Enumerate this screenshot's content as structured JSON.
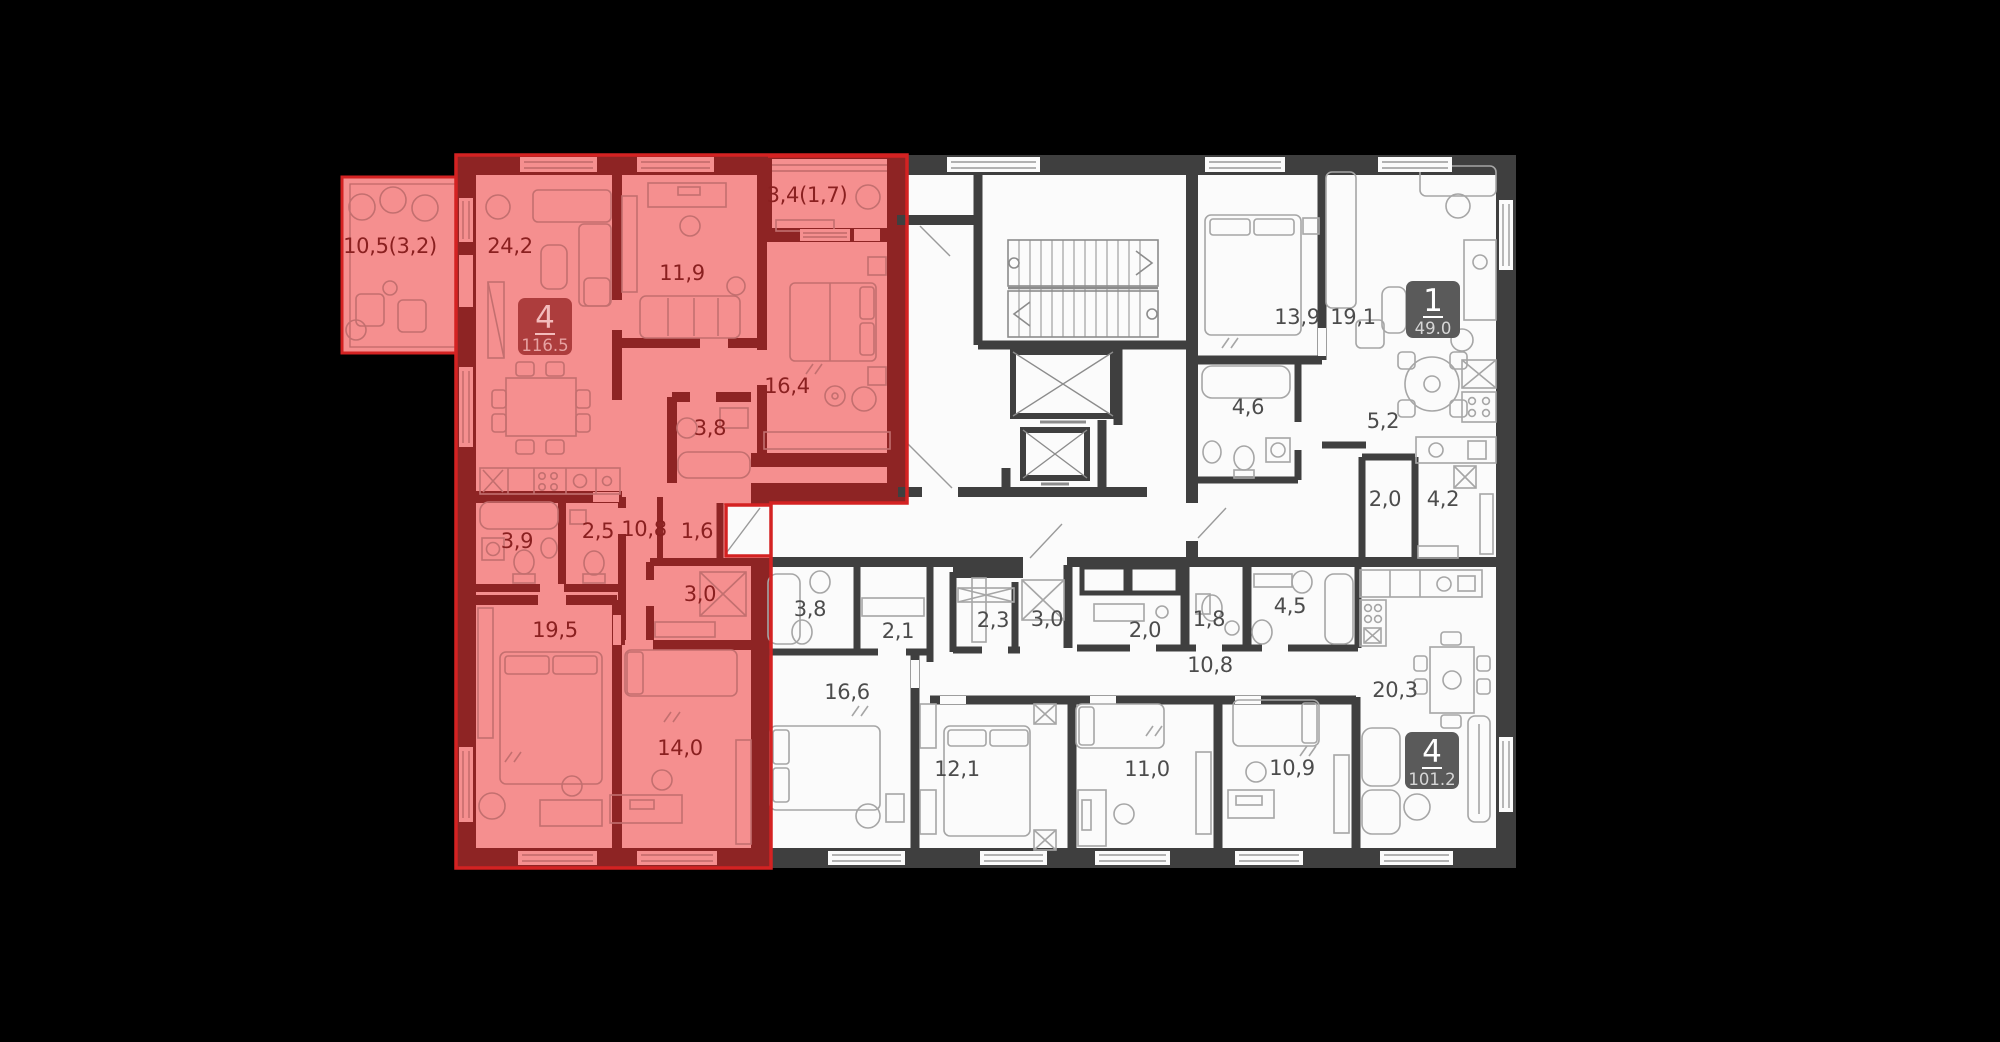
{
  "page": {
    "background": "#000000"
  },
  "plan": {
    "kind": "floorplan",
    "colors": {
      "wall": "#3f3f3f",
      "floor": "#fbfbfb",
      "furniture_line": "#a6a6a6",
      "highlight_fill": "#f58f8f",
      "highlight_wall": "#8e2424",
      "highlight_outline": "#d42222",
      "label": "#4c4c4c",
      "label_highlight": "#8a2020",
      "badge_bg": "#5a5a5a",
      "badge_bg_highlight": "#ad3d3d",
      "badge_text": "#ffffff",
      "badge_text_highlight": "#f3bcbc"
    },
    "apartments": [
      {
        "id": "apt-4room-highlighted",
        "rooms_count": "4",
        "total_area": "116.5",
        "highlighted": true,
        "badge": {
          "x": 545,
          "y": 327
        },
        "rooms": [
          {
            "label": "10,5(3,2)",
            "x": 390,
            "y": 253
          },
          {
            "label": "24,2",
            "x": 510,
            "y": 253
          },
          {
            "label": "11,9",
            "x": 682,
            "y": 280
          },
          {
            "label": "3,4(1,7)",
            "x": 807,
            "y": 202
          },
          {
            "label": "16,4",
            "x": 787,
            "y": 393
          },
          {
            "label": "3,8",
            "x": 710,
            "y": 435
          },
          {
            "label": "3,9",
            "x": 517,
            "y": 548
          },
          {
            "label": "2,5",
            "x": 598,
            "y": 538
          },
          {
            "label": "10,8",
            "x": 644,
            "y": 536
          },
          {
            "label": "1,6",
            "x": 697,
            "y": 538
          },
          {
            "label": "3,0",
            "x": 700,
            "y": 601
          },
          {
            "label": "19,5",
            "x": 555,
            "y": 637
          },
          {
            "label": "14,0",
            "x": 680,
            "y": 755
          }
        ]
      },
      {
        "id": "apt-1room",
        "rooms_count": "1",
        "total_area": "49.0",
        "highlighted": false,
        "badge": {
          "x": 1433,
          "y": 310
        },
        "rooms": [
          {
            "label": "13,9",
            "x": 1297,
            "y": 324
          },
          {
            "label": "19,1",
            "x": 1353,
            "y": 324
          },
          {
            "label": "4,6",
            "x": 1248,
            "y": 414
          },
          {
            "label": "5,2",
            "x": 1383,
            "y": 428
          },
          {
            "label": "2,0",
            "x": 1385,
            "y": 506
          },
          {
            "label": "4,2",
            "x": 1443,
            "y": 506
          }
        ]
      },
      {
        "id": "apt-4room-right",
        "rooms_count": "4",
        "total_area": "101.2",
        "highlighted": false,
        "badge": {
          "x": 1432,
          "y": 761
        },
        "rooms": [
          {
            "label": "3,8",
            "x": 810,
            "y": 616
          },
          {
            "label": "2,1",
            "x": 898,
            "y": 638
          },
          {
            "label": "2,3",
            "x": 993,
            "y": 627
          },
          {
            "label": "3,0",
            "x": 1047,
            "y": 626
          },
          {
            "label": "2,0",
            "x": 1145,
            "y": 637
          },
          {
            "label": "1,8",
            "x": 1209,
            "y": 626
          },
          {
            "label": "4,5",
            "x": 1290,
            "y": 613
          },
          {
            "label": "10,8",
            "x": 1210,
            "y": 672
          },
          {
            "label": "16,6",
            "x": 847,
            "y": 699
          },
          {
            "label": "12,1",
            "x": 957,
            "y": 776
          },
          {
            "label": "11,0",
            "x": 1147,
            "y": 776
          },
          {
            "label": "10,9",
            "x": 1292,
            "y": 775
          },
          {
            "label": "20,3",
            "x": 1395,
            "y": 697
          }
        ]
      }
    ]
  }
}
